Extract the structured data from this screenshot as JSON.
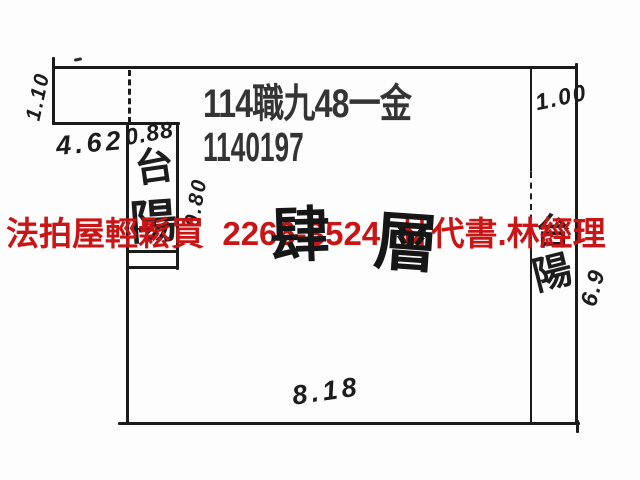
{
  "case": {
    "line1": "114職九48一金",
    "line2": "1140197"
  },
  "watermark": {
    "text": "法拍屋輕鬆買  2266-3524  林代書.林經理",
    "color": "#c91515"
  },
  "floor_label": {
    "char1": "肆",
    "char2": "層"
  },
  "balcony_left": {
    "top_char": "台",
    "bottom_char": "陽"
  },
  "balcony_right": {
    "top_char": "台",
    "bottom_char": "陽"
  },
  "measurements": {
    "top_left_vertical": "1.10",
    "top_left_width": "4.62",
    "left_strip_width": "0.88",
    "left_strip_side": "0.80",
    "right_strip_width": "1.00",
    "right_strip_length": "6.9",
    "bottom_width": "8.18"
  },
  "colors": {
    "ink": "#1b1b1b",
    "print_text": "#343434",
    "overlay_red": "#c91515",
    "paper": "#fdfdfd"
  }
}
